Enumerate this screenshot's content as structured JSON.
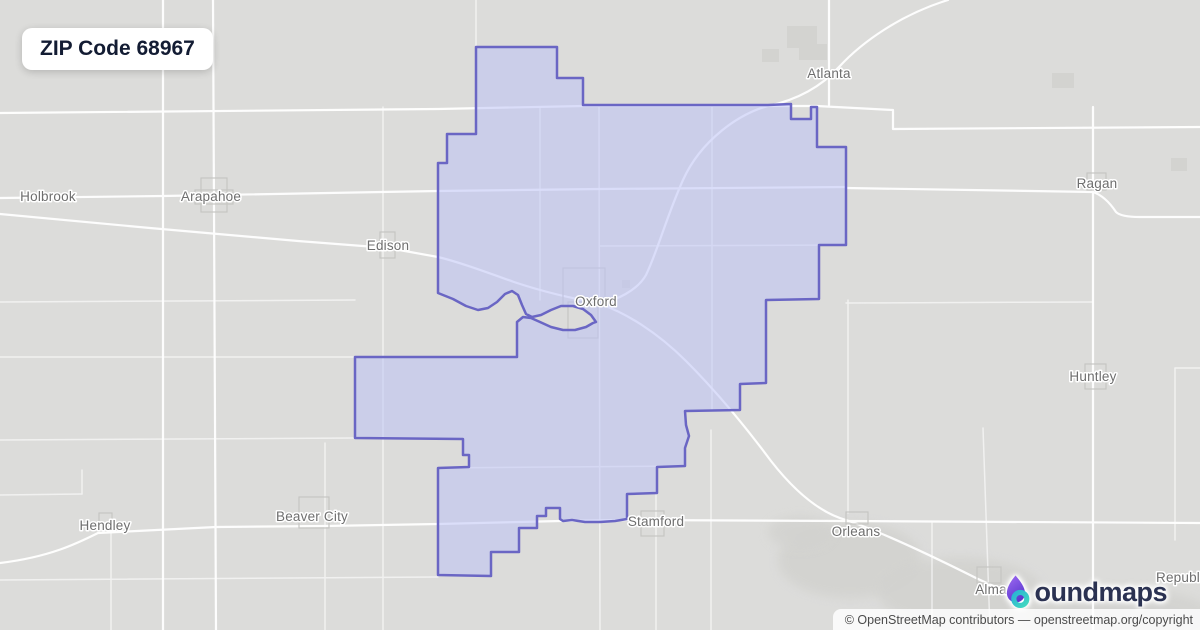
{
  "badge": {
    "title": "ZIP Code 68967"
  },
  "map": {
    "towns": [
      {
        "name": "Holbrook"
      },
      {
        "name": "Arapahoe"
      },
      {
        "name": "Edison"
      },
      {
        "name": "Oxford"
      },
      {
        "name": "Atlanta"
      },
      {
        "name": "Ragan"
      },
      {
        "name": "Huntley"
      },
      {
        "name": "Hendley"
      },
      {
        "name": "Beaver City"
      },
      {
        "name": "Stamford"
      },
      {
        "name": "Orleans"
      },
      {
        "name": "Alma"
      },
      {
        "name": "Republic"
      }
    ],
    "colors": {
      "map_background": "#dcdcda",
      "road": "#ffffff",
      "zip_fill": "#ccd0ec",
      "zip_border": "#6a66c4",
      "label": "#6e6e6e"
    }
  },
  "logo": {
    "brand": "boundmaps",
    "wordmark_text": "oundmaps"
  },
  "attribution": {
    "text": "© OpenStreetMap contributors — openstreetmap.org/copyright"
  }
}
